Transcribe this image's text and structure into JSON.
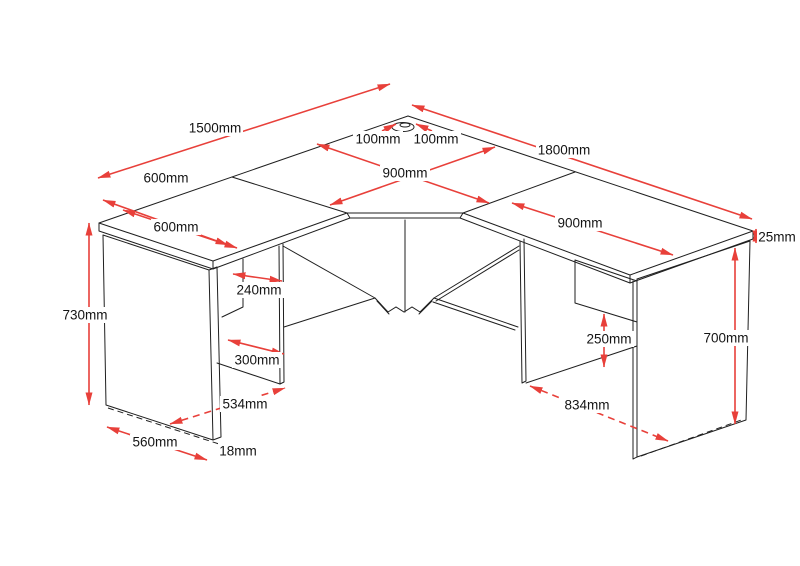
{
  "document": {
    "kind": "corner-desk-technical-drawing",
    "background": "#ffffff"
  },
  "colors": {
    "linework": "#1f1f1f",
    "dimension_red": "#e8403a",
    "label_text": "#141414"
  },
  "icons": {
    "cable_grommet": "grommet-hole-ellipse"
  },
  "dims": [
    {
      "id": "back-left-length",
      "label": "1500mm"
    },
    {
      "id": "left-end-depth",
      "label": "600mm"
    },
    {
      "id": "left-top-width",
      "label": "600mm"
    },
    {
      "id": "grommet-offset-left",
      "label": "100mm"
    },
    {
      "id": "grommet-offset-right",
      "label": "100mm"
    },
    {
      "id": "corner-section-width",
      "label": "900mm"
    },
    {
      "id": "back-right-length",
      "label": "1800mm"
    },
    {
      "id": "right-top-width",
      "label": "900mm"
    },
    {
      "id": "desktop-thickness",
      "label": "25mm"
    },
    {
      "id": "left-overall-height",
      "label": "730mm"
    },
    {
      "id": "left-opening-top",
      "label": "240mm"
    },
    {
      "id": "left-opening-bottom",
      "label": "300mm"
    },
    {
      "id": "left-inner-span",
      "label": "534mm"
    },
    {
      "id": "left-panel-depth",
      "label": "560mm"
    },
    {
      "id": "panel-thickness",
      "label": "18mm"
    },
    {
      "id": "right-modesty-gap",
      "label": "250mm"
    },
    {
      "id": "right-inner-span",
      "label": "834mm"
    },
    {
      "id": "right-panel-height",
      "label": "700mm"
    }
  ]
}
